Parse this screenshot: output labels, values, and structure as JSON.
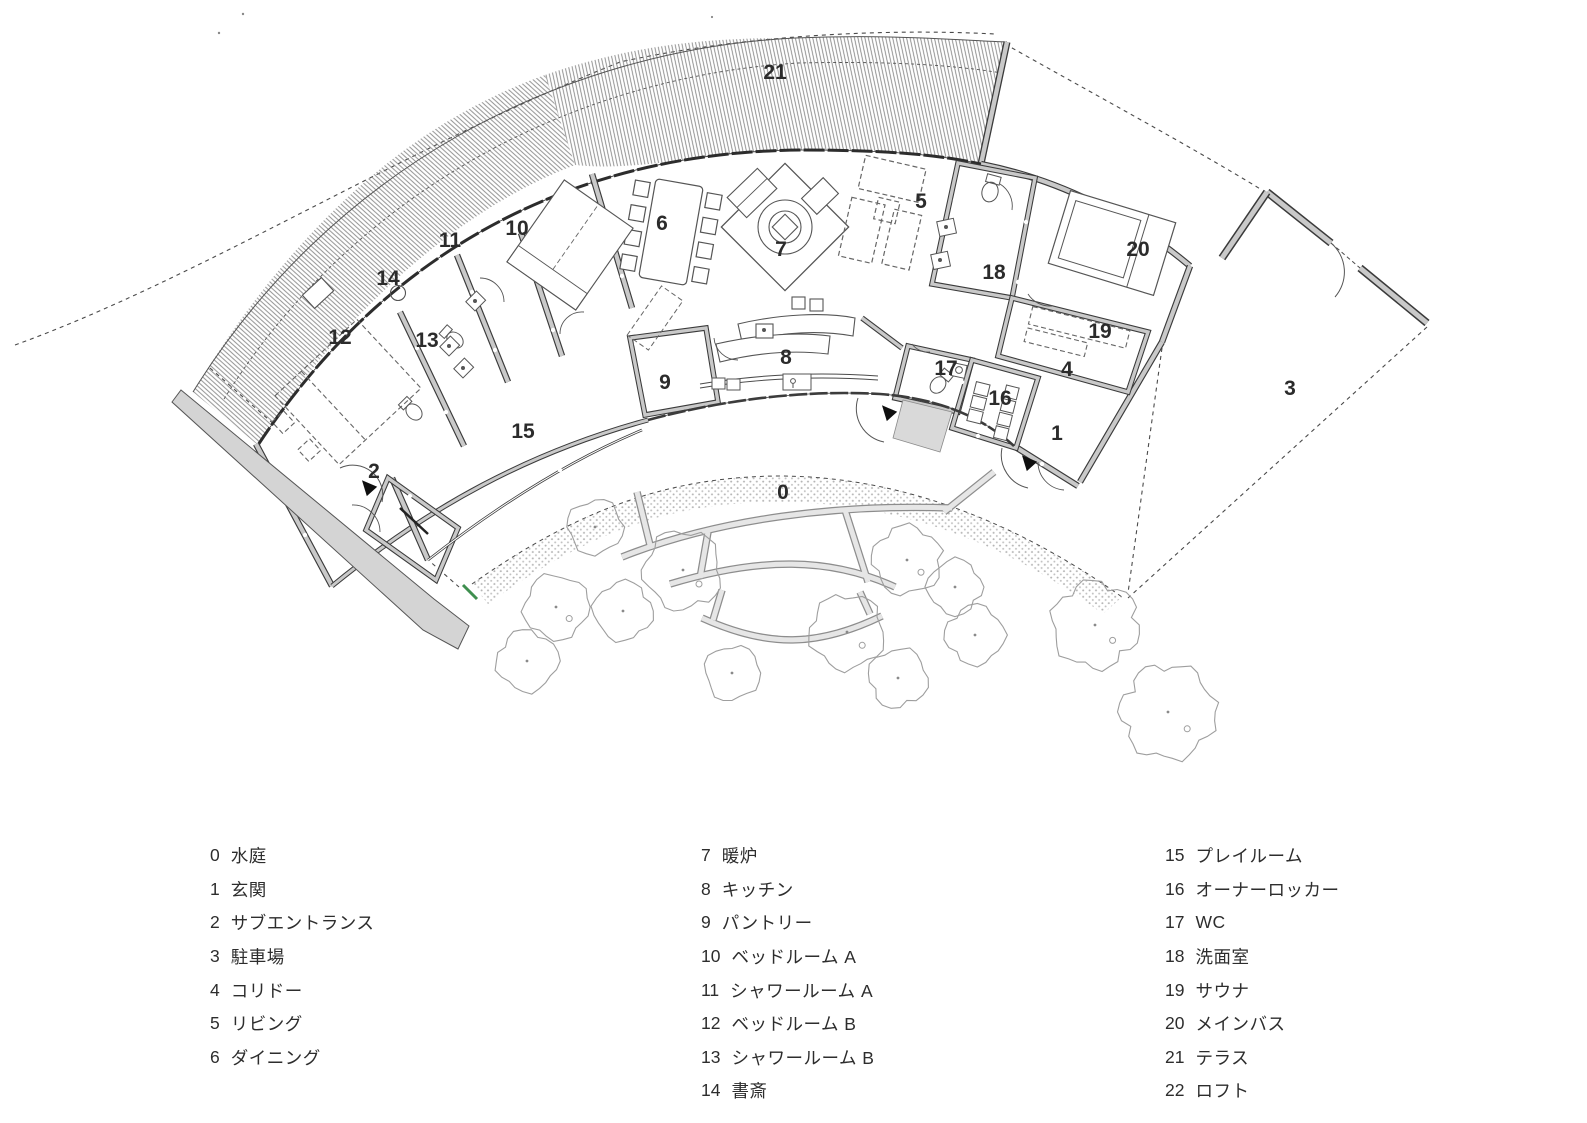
{
  "plan": {
    "labels": [
      "0",
      "1",
      "2",
      "3",
      "4",
      "5",
      "6",
      "7",
      "8",
      "9",
      "10",
      "11",
      "12",
      "13",
      "14",
      "15",
      "16",
      "17",
      "18",
      "19",
      "20",
      "21"
    ]
  },
  "legend": {
    "columns": [
      {
        "items": [
          {
            "num": "0",
            "name": "水庭"
          },
          {
            "num": "1",
            "name": "玄関"
          },
          {
            "num": "2",
            "name": "サブエントランス"
          },
          {
            "num": "3",
            "name": "駐車場"
          },
          {
            "num": "4",
            "name": "コリドー"
          },
          {
            "num": "5",
            "name": "リビング"
          },
          {
            "num": "6",
            "name": "ダイニング"
          }
        ]
      },
      {
        "items": [
          {
            "num": "7",
            "name": "暖炉"
          },
          {
            "num": "8",
            "name": "キッチン"
          },
          {
            "num": "9",
            "name": "パントリー"
          },
          {
            "num": "10",
            "name": "ベッドルーム A"
          },
          {
            "num": "11",
            "name": "シャワールーム A"
          },
          {
            "num": "12",
            "name": "ベッドルーム B"
          },
          {
            "num": "13",
            "name": "シャワールーム B"
          },
          {
            "num": "14",
            "name": "書斎"
          }
        ]
      },
      {
        "items": [
          {
            "num": "15",
            "name": "プレイルーム"
          },
          {
            "num": "16",
            "name": "オーナーロッカー"
          },
          {
            "num": "17",
            "name": "WC"
          },
          {
            "num": "18",
            "name": "洗面室"
          },
          {
            "num": "19",
            "name": "サウナ"
          },
          {
            "num": "20",
            "name": "メインバス"
          },
          {
            "num": "21",
            "name": "テラス"
          },
          {
            "num": "22",
            "name": "ロフト"
          }
        ]
      }
    ]
  },
  "colors": {
    "wall_fill": "#c9c9c9",
    "wall_edge": "#3a3a3a",
    "gravel_dot": "#b5b5b5",
    "green_mark": "#3f8f4f"
  }
}
